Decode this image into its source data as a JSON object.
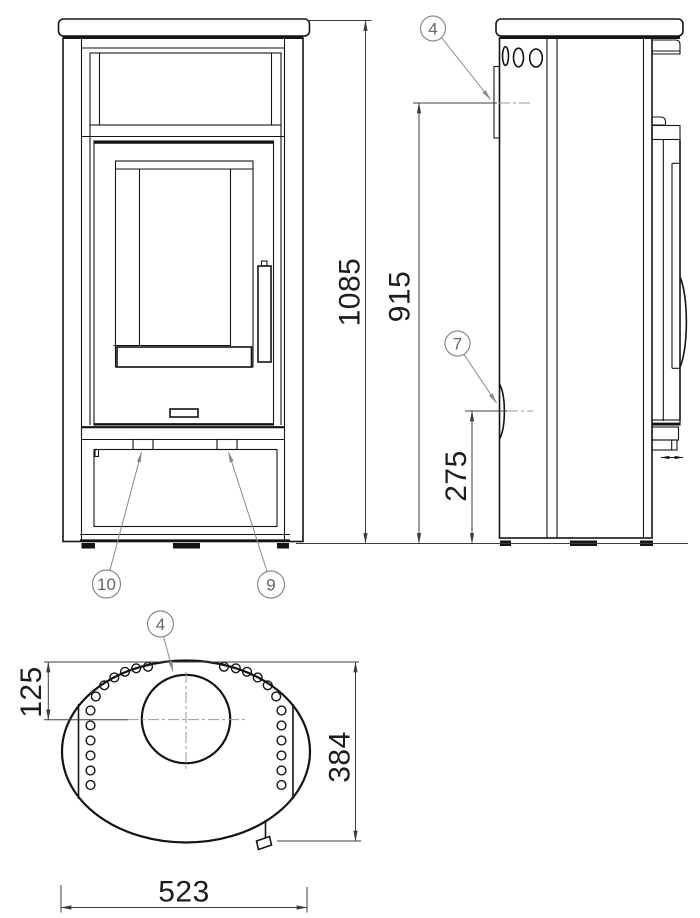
{
  "colors": {
    "ink": "#141414",
    "dimension_lines": "#3d3d3d",
    "callout_gray": "#8a8a8a",
    "background": "#ffffff"
  },
  "dimensions": {
    "overall_height": "1085",
    "rear_outlet_height": "915",
    "side_outlet_height": "275",
    "flue_center_offset": "125",
    "depth": "384",
    "width": "523"
  },
  "callouts": {
    "item_4": "4",
    "item_7": "7",
    "item_9": "9",
    "item_10": "10"
  }
}
